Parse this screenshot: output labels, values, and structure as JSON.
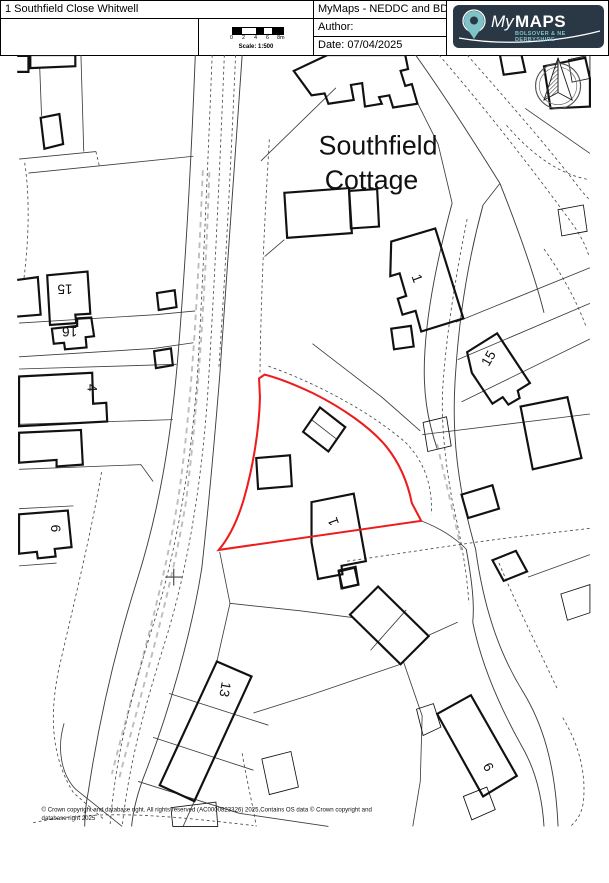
{
  "header": {
    "title": "1 Southfield Close Whitwell",
    "product": "MyMaps - NEDDC and BDC",
    "author_label": "Author:",
    "date_label": "Date: 07/04/2025",
    "scale": {
      "ticks": [
        "0",
        "2",
        "4",
        "6",
        "8m"
      ],
      "label": "Scale: 1:500"
    },
    "logo": {
      "brand_my": "My",
      "brand_maps": "MAPS",
      "tagline": "BOLSOVER & NE DERBYSHIRE",
      "pin_icon": "location-pin"
    }
  },
  "colors": {
    "site_outline": "#ee1d1d",
    "logo_bg": "#2a3845",
    "logo_accent": "#7fc3c9",
    "building_line": "#111111",
    "parcel_line": "#3d3d3d",
    "track_dash": "#bdbdbd"
  },
  "map": {
    "labels": [
      {
        "text": "Southfield"
      },
      {
        "text": "Cottage"
      },
      {
        "text": "1"
      },
      {
        "text": "1"
      },
      {
        "text": "15"
      },
      {
        "text": "16"
      },
      {
        "text": "4"
      },
      {
        "text": "6"
      },
      {
        "text": "13"
      },
      {
        "text": "15"
      },
      {
        "text": "9"
      }
    ],
    "compass_icon": "north-arrow",
    "cross_marker": "survey-cross"
  },
  "footer": {
    "copyright_line1": "© Crown copyright and database right. All rights reserved (AC0000823326) 2025,Contains OS data © Crown copyright and",
    "copyright_line2": "database right 2025"
  }
}
